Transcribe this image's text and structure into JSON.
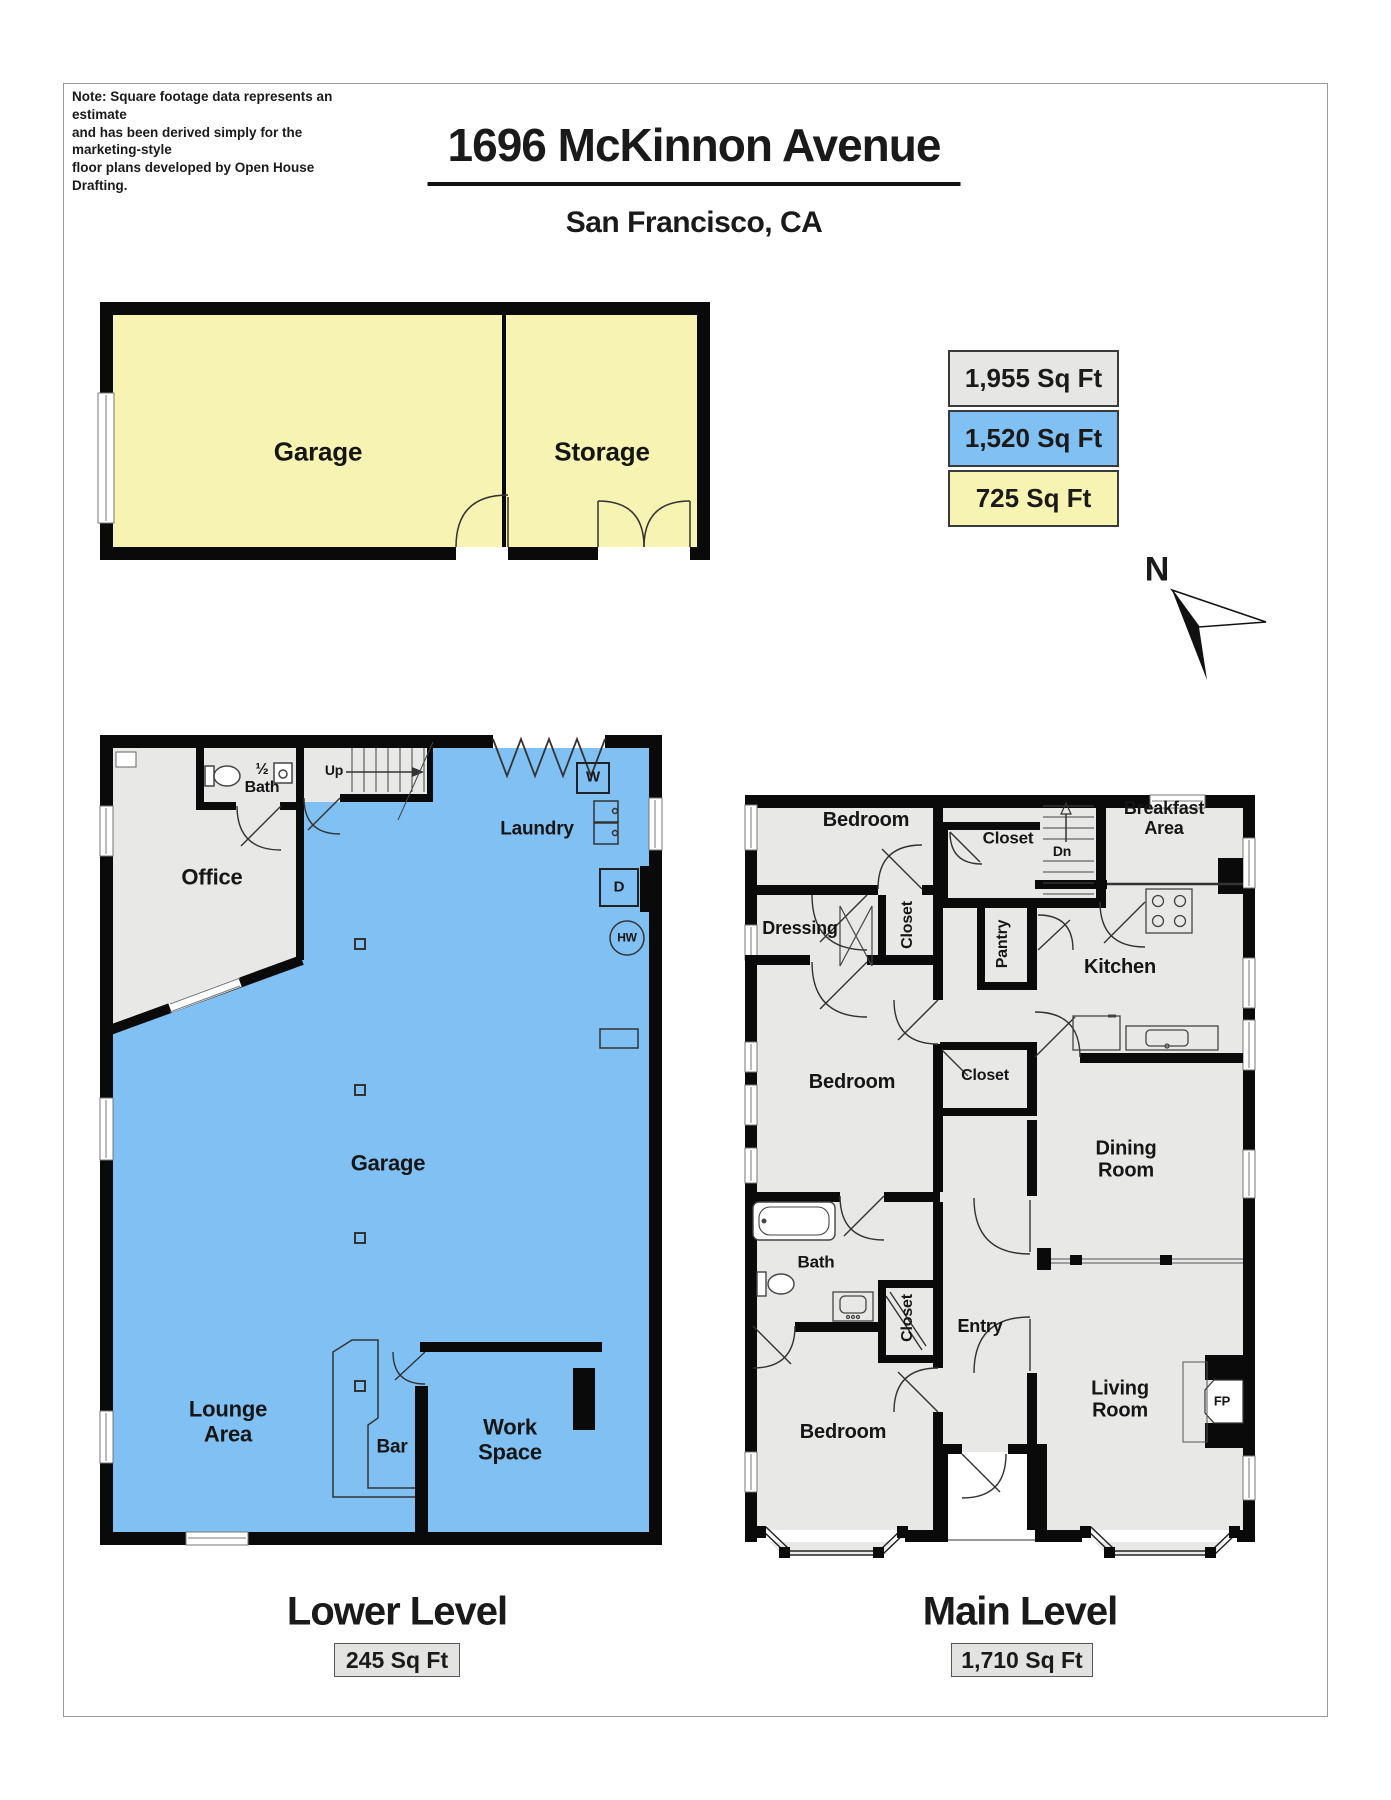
{
  "header": {
    "note": "Note: Square footage data represents an estimate\nand has been derived simply for the marketing-style\nfloor plans developed by Open House Drafting.",
    "title": "1696 McKinnon Avenue",
    "subtitle": "San Francisco, CA"
  },
  "legend": {
    "items": [
      {
        "name": "sqft-total",
        "label": "1,955 Sq Ft",
        "color": "#e6e6e5"
      },
      {
        "name": "sqft-blue",
        "label": "1,520 Sq Ft",
        "color": "#80c0f2"
      },
      {
        "name": "sqft-yellow",
        "label": "725 Sq Ft",
        "color": "#f7f3b2"
      }
    ]
  },
  "compass": {
    "label": "N"
  },
  "colors": {
    "yellow": "#f7f3b2",
    "blue": "#80c0f2",
    "gray": "#e8e8e7",
    "wall": "#0a0a0a"
  },
  "plans": {
    "garage": {
      "labels": [
        {
          "name": "garage-room",
          "text": "Garage",
          "x": 318,
          "y": 452,
          "size": 26
        },
        {
          "name": "storage-room",
          "text": "Storage",
          "x": 602,
          "y": 452,
          "size": 26
        }
      ]
    },
    "lower": {
      "title": "Lower Level",
      "sqft": "245 Sq Ft",
      "labels": [
        {
          "name": "half-bath",
          "text": "½\nBath",
          "x": 262,
          "y": 779,
          "size": 16
        },
        {
          "name": "up",
          "text": "Up",
          "x": 334,
          "y": 771,
          "size": 14
        },
        {
          "name": "laundry",
          "text": "Laundry",
          "x": 537,
          "y": 829,
          "size": 19
        },
        {
          "name": "washer",
          "text": "W",
          "x": 593,
          "y": 778,
          "size": 15
        },
        {
          "name": "dryer",
          "text": "D",
          "x": 619,
          "y": 888,
          "size": 15
        },
        {
          "name": "water-heater",
          "text": "HW",
          "x": 627,
          "y": 938,
          "size": 12
        },
        {
          "name": "office",
          "text": "Office",
          "x": 212,
          "y": 878,
          "size": 22
        },
        {
          "name": "garage",
          "text": "Garage",
          "x": 388,
          "y": 1164,
          "size": 22
        },
        {
          "name": "lounge-area",
          "text": "Lounge\nArea",
          "x": 228,
          "y": 1422,
          "size": 22
        },
        {
          "name": "bar",
          "text": "Bar",
          "x": 392,
          "y": 1447,
          "size": 19
        },
        {
          "name": "work-space",
          "text": "Work\nSpace",
          "x": 510,
          "y": 1440,
          "size": 22
        }
      ]
    },
    "main": {
      "title": "Main Level",
      "sqft": "1,710 Sq Ft",
      "labels": [
        {
          "name": "bedroom-1",
          "text": "Bedroom",
          "x": 866,
          "y": 820,
          "size": 20
        },
        {
          "name": "closet-1",
          "text": "Closet",
          "x": 1008,
          "y": 838,
          "size": 17
        },
        {
          "name": "dn",
          "text": "Dn",
          "x": 1062,
          "y": 852,
          "size": 14
        },
        {
          "name": "breakfast-area",
          "text": "Breakfast\nArea",
          "x": 1164,
          "y": 818,
          "size": 18
        },
        {
          "name": "pantry",
          "text": "Pantry",
          "x": 1003,
          "y": 944,
          "size": 16,
          "rot": true
        },
        {
          "name": "dressing",
          "text": "Dressing",
          "x": 800,
          "y": 928,
          "size": 18
        },
        {
          "name": "closet-2",
          "text": "Closet",
          "x": 908,
          "y": 925,
          "size": 16,
          "rot": true
        },
        {
          "name": "kitchen",
          "text": "Kitchen",
          "x": 1120,
          "y": 967,
          "size": 20
        },
        {
          "name": "bedroom-2",
          "text": "Bedroom",
          "x": 852,
          "y": 1082,
          "size": 20
        },
        {
          "name": "closet-3",
          "text": "Closet",
          "x": 985,
          "y": 1076,
          "size": 16
        },
        {
          "name": "dining-room",
          "text": "Dining\nRoom",
          "x": 1126,
          "y": 1160,
          "size": 20
        },
        {
          "name": "bath",
          "text": "Bath",
          "x": 816,
          "y": 1262,
          "size": 17
        },
        {
          "name": "closet-4",
          "text": "Closet",
          "x": 908,
          "y": 1318,
          "size": 16,
          "rot": true
        },
        {
          "name": "entry",
          "text": "Entry",
          "x": 980,
          "y": 1326,
          "size": 18
        },
        {
          "name": "bedroom-3",
          "text": "Bedroom",
          "x": 843,
          "y": 1432,
          "size": 20
        },
        {
          "name": "living-room",
          "text": "Living\nRoom",
          "x": 1120,
          "y": 1400,
          "size": 20
        },
        {
          "name": "fireplace",
          "text": "FP",
          "x": 1222,
          "y": 1402,
          "size": 13
        }
      ]
    }
  }
}
